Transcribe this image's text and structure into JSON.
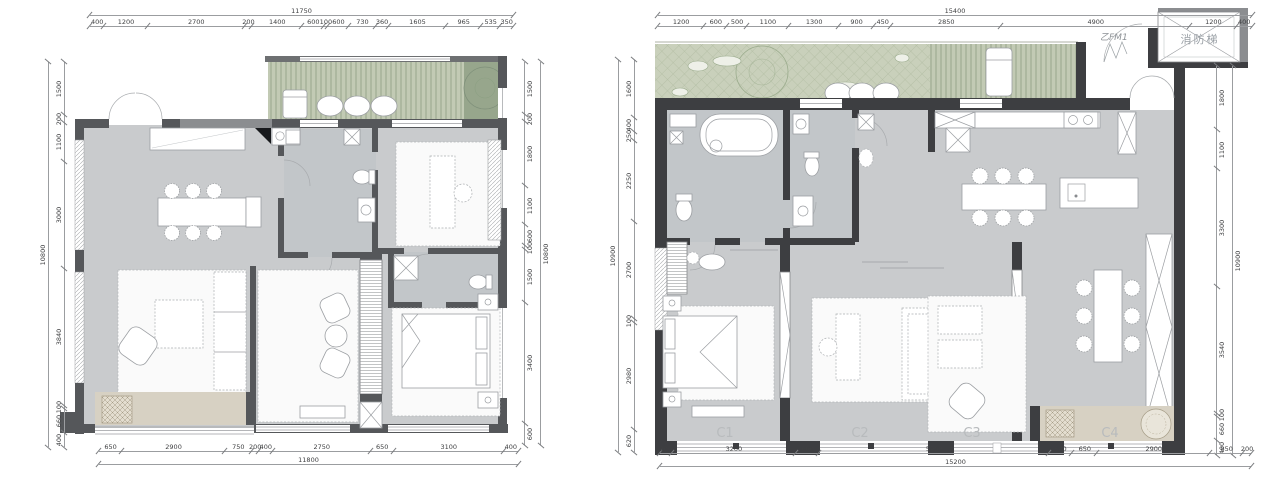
{
  "left_plan": {
    "dims": {
      "top_total": "11750",
      "top": [
        "400",
        "1200",
        "2700",
        "200",
        "1400",
        "600",
        "100",
        "600",
        "730",
        "360",
        "1605",
        "965",
        "535",
        "350"
      ],
      "left_total": "10800",
      "left": [
        "1500",
        "200",
        "1100",
        "3000",
        "3840",
        "100",
        "660",
        "400"
      ],
      "right_total": "10800",
      "right": [
        "1500",
        "200",
        "1800",
        "1100",
        "600",
        "100",
        "1500",
        "3400",
        "600"
      ],
      "bottom_total": "11800",
      "bottom": [
        "650",
        "2900",
        "750",
        "200",
        "400",
        "2750",
        "650",
        "3100",
        "400"
      ]
    }
  },
  "right_plan": {
    "dims": {
      "top_total": "15400",
      "top": [
        "1200",
        "600",
        "500",
        "1100",
        "1300",
        "900",
        "450",
        "2850",
        "4900",
        "1200",
        "400"
      ],
      "left_total": "10900",
      "left": [
        "1600",
        "400",
        "250",
        "2250",
        "2700",
        "100",
        "2980",
        "620"
      ],
      "right_total": "10900",
      "right": [
        "1800",
        "1100",
        "3300",
        "3540",
        "100",
        "660",
        "400"
      ],
      "bottom_total": "15200",
      "bottom": [
        "300",
        "3200",
        "600",
        "5900",
        "600",
        "650",
        "2900",
        "850",
        "200"
      ]
    },
    "labels": {
      "fire_stair": "消防梯",
      "fire_door": "乙FM1",
      "window_codes": [
        "C1",
        "C2",
        "C3",
        "C4"
      ]
    }
  },
  "colors": {
    "wall_left_plan": "#55575a",
    "wall_right_plan": "#3d3e41",
    "floor": "#c9cbcd",
    "floor_bath": "#c2c6c9",
    "balcony": "#d7d1c3",
    "garden_green": "#c9d0bb",
    "deck_stripe_green": "#b7c0aa",
    "dimension_text": "#3f4042",
    "window_code_text": "#b8bbbd"
  }
}
